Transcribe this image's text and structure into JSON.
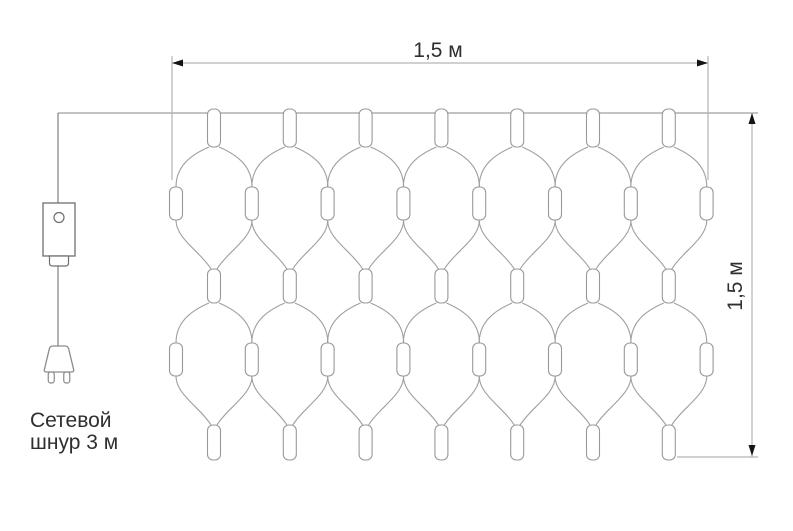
{
  "diagram": {
    "title": "net-light-garland-dimension-diagram",
    "labels": {
      "width": "1,5 м",
      "height": "1,5 м",
      "cord_line1": "Сетевой",
      "cord_line2": "шнур 3 м"
    },
    "bulb_counts": {
      "top_row": 7,
      "middle_row": 7,
      "bottom_row": 7,
      "side_bulbs_per_tier": 8,
      "total": 37
    },
    "colors": {
      "net_line": "#9f9f9f",
      "bulb_stroke": "#999999",
      "bulb_fill": "#ffffff",
      "cord": "#8a8a8a",
      "box_stroke": "#6f6f6f",
      "dim_line": "#b4b4b4",
      "arrow": "#141414",
      "text": "#2f2f2f",
      "background": "#ffffff"
    },
    "geometry": {
      "canvas": {
        "w": 793,
        "h": 531
      },
      "top_line": {
        "y": 113,
        "x1": 58,
        "x2": 758
      },
      "net": {
        "left": 176,
        "spacing": 75.8,
        "half": 38,
        "columns": 7,
        "side_count": 8,
        "rows": [
          {
            "top": 147,
            "side_top": 187,
            "side_bottom": 220,
            "bottom": 269
          },
          {
            "top": 303,
            "side_top": 343,
            "side_bottom": 376,
            "bottom": 425
          }
        ],
        "bulb_w": 13,
        "top_bulb": {
          "y": 109,
          "h": 38
        },
        "mid_bulb": {
          "y": 269,
          "h": 34
        },
        "bottom_bulb": {
          "y": 425,
          "h": 35
        },
        "side_bulb_h": 33
      },
      "cord": {
        "x": 58,
        "wire_top": [
          113,
          203
        ],
        "wire_bottom": [
          266,
          346
        ],
        "box": {
          "x": 43,
          "y": 203,
          "w": 32,
          "h": 53
        },
        "box_circle": {
          "cx": 59,
          "cy": 217.5,
          "r": 5
        },
        "connector": {
          "x": 49.5,
          "y": 256,
          "w": 19,
          "h": 10
        },
        "plug": {
          "cx": 59,
          "top_y": 346,
          "top_w": 18,
          "bottom_w": 31,
          "h": 26,
          "prong_w": 6,
          "prong_h": 11,
          "prong_offset": 7.75
        }
      },
      "dim_top": {
        "y": 63,
        "x1": 172,
        "x2": 708,
        "ext_y1": 56,
        "ext_y2": 180,
        "label_x": 438,
        "label_y": 57
      },
      "dim_right": {
        "x": 752,
        "y1": 113,
        "y2": 457,
        "ext_y": 457,
        "ext_x1": 677,
        "ext_x2": 758,
        "label_cx": 735,
        "label_cy": 286
      },
      "cord_label": {
        "x": 30,
        "y1": 427,
        "y2": 449
      }
    }
  }
}
